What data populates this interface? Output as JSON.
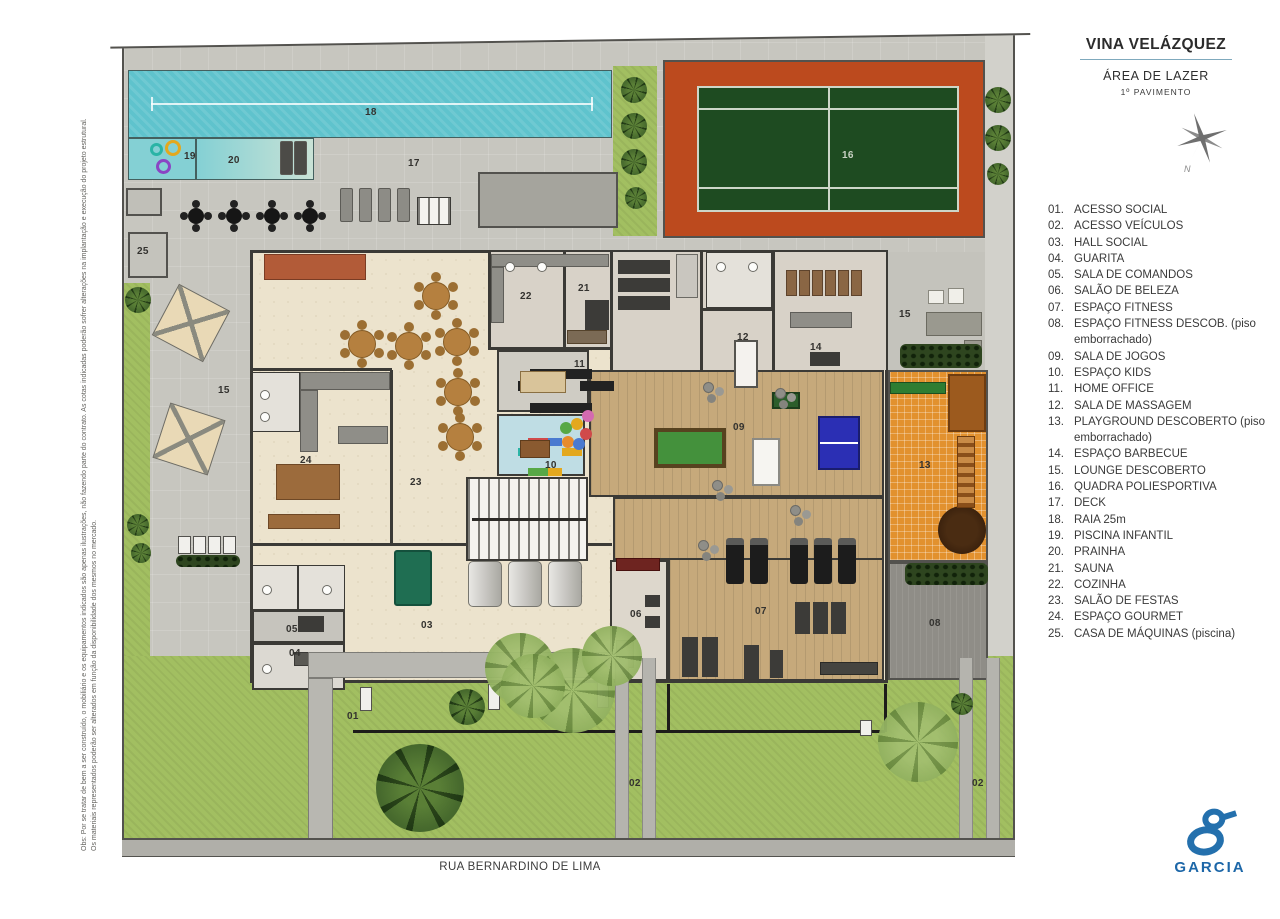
{
  "header": {
    "title": "VINA VELÁZQUEZ",
    "subtitle": "ÁREA DE LAZER",
    "subtitle2": "1º PAVIMENTO",
    "compass_label": "N"
  },
  "legend": {
    "items": [
      {
        "num": "01.",
        "label": "ACESSO SOCIAL"
      },
      {
        "num": "02.",
        "label": "ACESSO VEÍCULOS"
      },
      {
        "num": "03.",
        "label": "HALL SOCIAL"
      },
      {
        "num": "04.",
        "label": "GUARITA"
      },
      {
        "num": "05.",
        "label": "SALA DE COMANDOS"
      },
      {
        "num": "06.",
        "label": "SALÃO DE BELEZA"
      },
      {
        "num": "07.",
        "label": "ESPAÇO FITNESS"
      },
      {
        "num": "08.",
        "label": "ESPAÇO FITNESS DESCOB. (piso emborrachado)"
      },
      {
        "num": "09.",
        "label": "SALA DE JOGOS"
      },
      {
        "num": "10.",
        "label": "ESPAÇO KIDS"
      },
      {
        "num": "11.",
        "label": "HOME OFFICE"
      },
      {
        "num": "12.",
        "label": "SALA DE MASSAGEM"
      },
      {
        "num": "13.",
        "label": "PLAYGROUND DESCOBERTO (piso emborrachado)"
      },
      {
        "num": "14.",
        "label": "ESPAÇO BARBECUE"
      },
      {
        "num": "15.",
        "label": "LOUNGE DESCOBERTO"
      },
      {
        "num": "16.",
        "label": "QUADRA POLIESPORTIVA"
      },
      {
        "num": "17.",
        "label": "DECK"
      },
      {
        "num": "18.",
        "label": "RAIA 25m"
      },
      {
        "num": "19.",
        "label": "PISCINA INFANTIL"
      },
      {
        "num": "20.",
        "label": "PRAINHA"
      },
      {
        "num": "21.",
        "label": "SAUNA"
      },
      {
        "num": "22.",
        "label": "COZINHA"
      },
      {
        "num": "23.",
        "label": "SALÃO DE FESTAS"
      },
      {
        "num": "24.",
        "label": "ESPAÇO GOURMET"
      },
      {
        "num": "25.",
        "label": "CASA DE MÁQUINAS (piscina)"
      }
    ]
  },
  "street_label": "RUA BERNARDINO DE LIMA",
  "logo": {
    "text": "GARCIA"
  },
  "disclaimer": {
    "line1": "Obs: Por se tratar de bem a ser construído, o mobiliário e os equipamentos indicados são apenas ilustrações, não fazendo parte do contrato. As cotas indicadas poderão sofrer alterações na implantação e execução do projeto estrutural.",
    "line2": "Os materiais representados poderão ser alterados em função da disponibilidade dos mesmos no mercado."
  },
  "colors": {
    "pool": "#5fc3cd",
    "kids_pool": "#84d0d4",
    "court_green": "#1e4b21",
    "court_surround": "#bc4a1e",
    "playground_orange": "#e2912e",
    "grass": "#a2bf61",
    "wood_floor": "#c6a97b",
    "marble_cream": "#ece3cd",
    "paving_gray": "#c7c6bf",
    "logo_blue": "#1d67a8"
  },
  "plan": {
    "labels": [
      {
        "t": "18",
        "x": 365,
        "y": 107
      },
      {
        "t": "19",
        "x": 184,
        "y": 151
      },
      {
        "t": "20",
        "x": 228,
        "y": 155
      },
      {
        "t": "17",
        "x": 408,
        "y": 158
      },
      {
        "t": "25",
        "x": 137,
        "y": 246
      },
      {
        "t": "16",
        "x": 842,
        "y": 150,
        "light": true
      },
      {
        "t": "15",
        "x": 218,
        "y": 385
      },
      {
        "t": "15",
        "x": 899,
        "y": 309
      },
      {
        "t": "22",
        "x": 520,
        "y": 291
      },
      {
        "t": "21",
        "x": 578,
        "y": 283
      },
      {
        "t": "12",
        "x": 737,
        "y": 332
      },
      {
        "t": "14",
        "x": 810,
        "y": 342
      },
      {
        "t": "11",
        "x": 574,
        "y": 359
      },
      {
        "t": "10",
        "x": 545,
        "y": 460
      },
      {
        "t": "09",
        "x": 733,
        "y": 422
      },
      {
        "t": "13",
        "x": 919,
        "y": 460
      },
      {
        "t": "24",
        "x": 300,
        "y": 455
      },
      {
        "t": "23",
        "x": 410,
        "y": 477
      },
      {
        "t": "07",
        "x": 755,
        "y": 606
      },
      {
        "t": "08",
        "x": 929,
        "y": 618
      },
      {
        "t": "06",
        "x": 630,
        "y": 609
      },
      {
        "t": "03",
        "x": 421,
        "y": 620
      },
      {
        "t": "05",
        "x": 286,
        "y": 624
      },
      {
        "t": "04",
        "x": 289,
        "y": 648
      },
      {
        "t": "01",
        "x": 347,
        "y": 711
      },
      {
        "t": "02",
        "x": 629,
        "y": 778
      },
      {
        "t": "02",
        "x": 972,
        "y": 778
      }
    ],
    "palms": [
      {
        "x": 420,
        "y": 788,
        "d": 88
      },
      {
        "x": 467,
        "y": 707,
        "d": 36
      },
      {
        "x": 138,
        "y": 300,
        "d": 26
      },
      {
        "x": 138,
        "y": 525,
        "d": 22
      },
      {
        "x": 141,
        "y": 553,
        "d": 20
      },
      {
        "x": 634,
        "y": 90,
        "d": 26
      },
      {
        "x": 634,
        "y": 126,
        "d": 26
      },
      {
        "x": 634,
        "y": 162,
        "d": 26
      },
      {
        "x": 636,
        "y": 198,
        "d": 22
      },
      {
        "x": 998,
        "y": 100,
        "d": 26
      },
      {
        "x": 998,
        "y": 138,
        "d": 26
      },
      {
        "x": 998,
        "y": 174,
        "d": 22
      },
      {
        "x": 962,
        "y": 704,
        "d": 22
      }
    ],
    "canopies": [
      {
        "x": 520,
        "y": 668,
        "d": 70
      },
      {
        "x": 572,
        "y": 690,
        "d": 85
      },
      {
        "x": 612,
        "y": 656,
        "d": 60
      },
      {
        "x": 918,
        "y": 742,
        "d": 80
      },
      {
        "x": 533,
        "y": 686,
        "d": 64
      }
    ],
    "deck_sets": [
      {
        "x": 188,
        "y": 208
      },
      {
        "x": 226,
        "y": 208
      },
      {
        "x": 264,
        "y": 208
      },
      {
        "x": 302,
        "y": 208
      }
    ],
    "loungers_gray": [
      {
        "x": 340,
        "y": 188
      },
      {
        "x": 359,
        "y": 188
      },
      {
        "x": 378,
        "y": 188
      },
      {
        "x": 397,
        "y": 188
      }
    ],
    "loungers_dark": [
      {
        "x": 280,
        "y": 141
      },
      {
        "x": 294,
        "y": 141
      }
    ],
    "round_tables": [
      {
        "x": 422,
        "y": 282
      },
      {
        "x": 348,
        "y": 330
      },
      {
        "x": 395,
        "y": 332
      },
      {
        "x": 443,
        "y": 328
      },
      {
        "x": 444,
        "y": 378
      },
      {
        "x": 446,
        "y": 423
      }
    ],
    "treadmills": [
      {
        "x": 726,
        "y": 538
      },
      {
        "x": 750,
        "y": 538
      },
      {
        "x": 790,
        "y": 538
      },
      {
        "x": 814,
        "y": 538
      },
      {
        "x": 838,
        "y": 538
      }
    ],
    "swim_rings": [
      {
        "x": 150,
        "y": 143,
        "d": 13,
        "c": "#2ab4a6"
      },
      {
        "x": 165,
        "y": 140,
        "d": 16,
        "c": "#e3a81e"
      },
      {
        "x": 156,
        "y": 159,
        "d": 15,
        "c": "#8a45c4"
      }
    ],
    "pouf_clusters": [
      {
        "x": 703,
        "y": 382
      },
      {
        "x": 775,
        "y": 388
      },
      {
        "x": 712,
        "y": 480
      },
      {
        "x": 698,
        "y": 540
      },
      {
        "x": 790,
        "y": 505
      }
    ],
    "bbq_chairs": [
      {
        "x": 786,
        "y": 270
      },
      {
        "x": 799,
        "y": 270
      },
      {
        "x": 812,
        "y": 270
      },
      {
        "x": 825,
        "y": 270
      },
      {
        "x": 838,
        "y": 270
      },
      {
        "x": 851,
        "y": 270
      }
    ],
    "toilets": [
      {
        "x": 262,
        "y": 585
      },
      {
        "x": 322,
        "y": 585
      },
      {
        "x": 262,
        "y": 664
      },
      {
        "x": 505,
        "y": 262
      },
      {
        "x": 537,
        "y": 262
      },
      {
        "x": 716,
        "y": 262
      },
      {
        "x": 748,
        "y": 262
      },
      {
        "x": 260,
        "y": 390
      },
      {
        "x": 260,
        "y": 412
      }
    ]
  }
}
